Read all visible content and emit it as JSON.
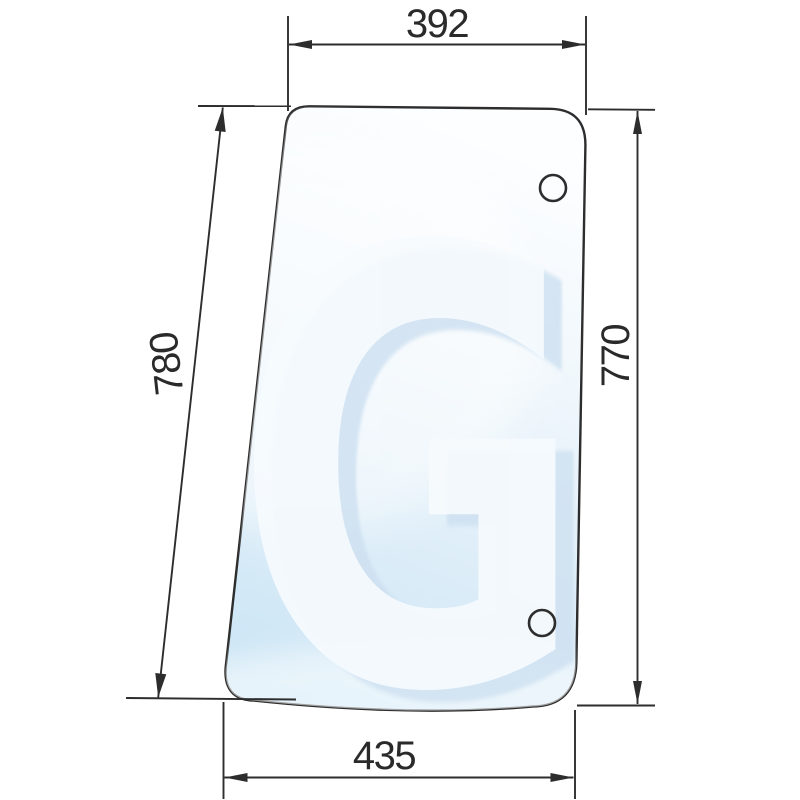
{
  "drawing": {
    "type": "side-glass-pane-technical-drawing",
    "watermark_letter": "G",
    "dimensions": {
      "top_width": "392",
      "bottom_width": "435",
      "left_height": "780",
      "right_height": "770"
    },
    "holes_count": 2,
    "colors": {
      "outline": "#2d2d2d",
      "glass_tint_top": "#fdfeff",
      "glass_tint_bottom": "#cbe5f5",
      "watermark_shadow": "#cfe1f1",
      "watermark_main": "#f7fbfe"
    }
  }
}
